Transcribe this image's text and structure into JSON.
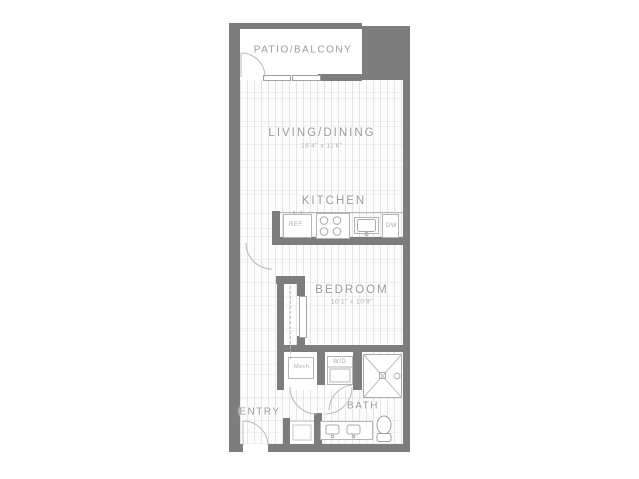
{
  "plan_title": "Studio apartment floor plan",
  "colors": {
    "wall": "#7d7d7d",
    "fixture_line": "#b9b9b9",
    "label": "#9b9b9b"
  },
  "rooms": {
    "patio": {
      "label": "PATIO/BALCONY"
    },
    "living": {
      "label": "LIVING/DINING",
      "dims": "16'4\" x 11'6\""
    },
    "kitchen": {
      "label": "KITCHEN"
    },
    "bedroom": {
      "label": "BEDROOM",
      "dims": "10'1\" x 10'8\""
    },
    "bath": {
      "label": "BATH"
    },
    "entry": {
      "label": "ENTRY"
    },
    "mech_closet": {
      "label": "Mech"
    },
    "laundry_closet": {
      "label": "W/D"
    }
  },
  "fixtures": {
    "refrigerator": "REF.",
    "dishwasher": "DW"
  }
}
